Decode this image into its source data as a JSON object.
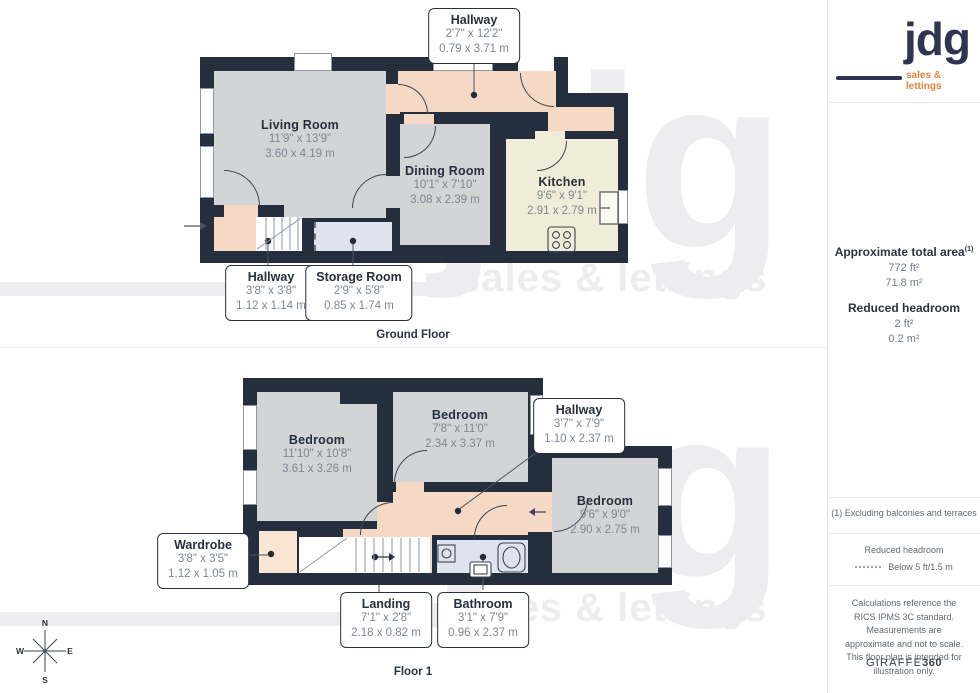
{
  "brand": {
    "logo_text": "jdg",
    "logo_tagline": "sales & lettings",
    "watermark_text": "jdg",
    "watermark_tagline": "sales & lettings"
  },
  "floors": {
    "ground": {
      "caption": "Ground Floor",
      "rooms": {
        "living": {
          "name": "Living Room",
          "ft": "11'9\" x 13'9\"",
          "m": "3.60 x 4.19 m"
        },
        "dining": {
          "name": "Dining Room",
          "ft": "10'1\" x 7'10\"",
          "m": "3.08 x 2.39 m"
        },
        "kitchen": {
          "name": "Kitchen",
          "ft": "9'6\" x 9'1\"",
          "m": "2.91 x 2.79 m"
        },
        "hallway_top": {
          "name": "Hallway",
          "ft": "2'7\" x 12'2\"",
          "m": "0.79 x 3.71 m"
        },
        "hallway_bottom": {
          "name": "Hallway",
          "ft": "3'8\" x 3'8\"",
          "m": "1.12 x 1.14 m"
        },
        "storage": {
          "name": "Storage Room",
          "ft": "2'9\" x 5'8\"",
          "m": "0.85 x 1.74 m"
        }
      }
    },
    "first": {
      "caption": "Floor 1",
      "rooms": {
        "bedroom_left": {
          "name": "Bedroom",
          "ft": "11'10\" x 10'8\"",
          "m": "3.61 x 3.26 m"
        },
        "bedroom_mid": {
          "name": "Bedroom",
          "ft": "7'8\" x 11'0\"",
          "m": "2.34 x 3.37 m"
        },
        "bedroom_right": {
          "name": "Bedroom",
          "ft": "9'6\" x 9'0\"",
          "m": "2.90 x 2.75 m"
        },
        "hallway": {
          "name": "Hallway",
          "ft": "3'7\" x 7'9\"",
          "m": "1.10 x 2.37 m"
        },
        "wardrobe": {
          "name": "Wardrobe",
          "ft": "3'8\" x 3'5\"",
          "m": "1.12 x 1.05 m"
        },
        "landing": {
          "name": "Landing",
          "ft": "7'1\" x 2'8\"",
          "m": "2.18 x 0.82 m"
        },
        "bathroom": {
          "name": "Bathroom",
          "ft": "3'1\" x 7'9\"",
          "m": "0.96 x 2.37 m"
        }
      }
    }
  },
  "sidebar": {
    "area_title": "Approximate total area",
    "area_superscript": "(1)",
    "area_ft": "772 ft²",
    "area_m": "71.8 m²",
    "reduced_title": "Reduced headroom",
    "reduced_ft": "2 ft²",
    "reduced_m": "0.2 m²",
    "note1": "(1) Excluding balconies and terraces",
    "legend_title": "Reduced headroom",
    "legend_value": "Below 5 ft/1.5 m",
    "disclaimer": "Calculations reference the RICS IPMS 3C standard. Measurements are approximate and not to scale. This floor plan is intended for illustration only.",
    "brand_name": "GIRAFFE",
    "brand_number": "360"
  },
  "compass": {
    "n": "N",
    "e": "E",
    "s": "S",
    "w": "W"
  },
  "colors": {
    "wall": "#242e3c",
    "room_gray": "#d2d4d6",
    "hall_peach": "#f5d9c4",
    "kitchen_cream": "#f1ecd8",
    "wet_blue": "#dfe3ed",
    "logo_navy": "#2e3452",
    "logo_orange": "#e5853f"
  }
}
